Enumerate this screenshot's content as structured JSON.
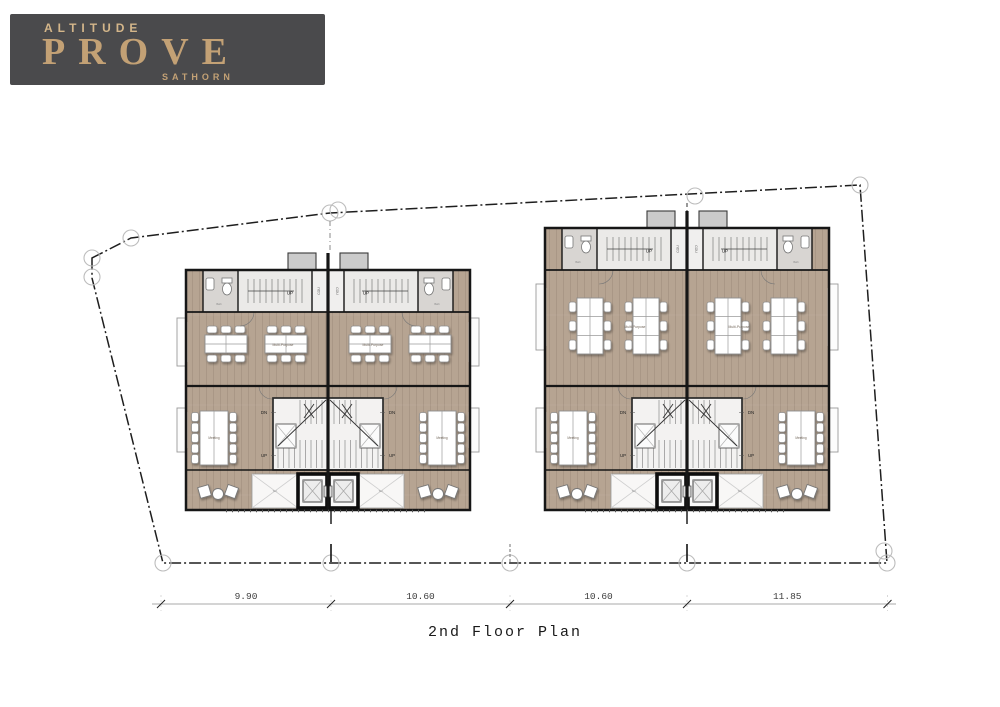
{
  "logo": {
    "brand": "ALTITUDE",
    "name": "PROVE",
    "location": "SATHORN"
  },
  "title": "2nd Floor Plan",
  "dimensions": {
    "values": [
      "9.90",
      "10.60",
      "10.60",
      "11.85"
    ]
  },
  "plan_labels": {
    "up": "UP",
    "down": "DN",
    "court": "COU",
    "office": "Multi-Purpose",
    "meeting": "Meeting",
    "terrace": "Ter.",
    "bath": "Bath"
  },
  "colors": {
    "logo_bg": "#4a4a4c",
    "logo_gold": "#c3a175",
    "logo_gold_light": "#d4b68a",
    "wall": "#161616",
    "wood_floor": "#b6a492",
    "gray_floor": "#e2dfdc",
    "stair_floor": "#ebeae8",
    "bath_floor": "#d8d5d2",
    "core_floor": "#f3f2f1",
    "terrace_floor": "#f8f7f6",
    "protrusion": "#cbcbcb",
    "boundary": "#1e1e1e",
    "dim_text": "#3c3c3c"
  }
}
